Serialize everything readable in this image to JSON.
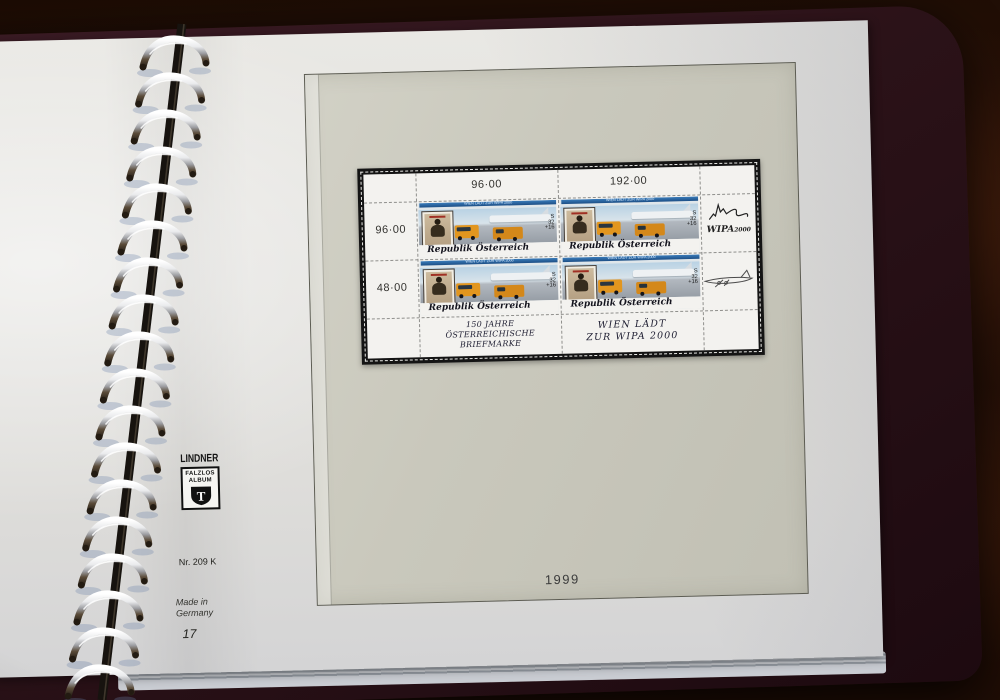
{
  "album": {
    "brand": {
      "name": "LINDNER",
      "box_line1": "FALZLOS",
      "box_line2": "ALBUM",
      "monogram": "T"
    },
    "ref_number": "Nr. 209 K",
    "made_in": {
      "line1": "Made in",
      "line2": "Germany"
    },
    "page_number": "17",
    "year_label": "1999",
    "binder": {
      "ring_count": 18
    }
  },
  "sheet": {
    "top_labels": [
      {
        "text": "96·00"
      },
      {
        "text": "192·00"
      }
    ],
    "left_labels": [
      {
        "text": "96·00"
      },
      {
        "text": "48·00"
      }
    ],
    "caption_left": {
      "line1": "150 JAHRE",
      "line2": "ÖSTERREICHISCHE",
      "line3": "BRIEFMARKE"
    },
    "caption_right": {
      "line1": "WIEN LÄDT",
      "line2": "ZUR WIPA 2000"
    },
    "wipa_logo": {
      "text_main": "WIPA",
      "text_year": "2000"
    },
    "stamp_count": 4,
    "stamp": {
      "top_banner": "WIEN LÄDT ZUR WIPA 2000",
      "country_script": "Republik Österreich",
      "currency": "S",
      "value": "32",
      "surcharge": "+16",
      "inner_stamp_title": "Republik Österreich"
    }
  },
  "colors": {
    "table_wood": "#2a1208",
    "album_cover": "#2b1218",
    "page_paper": "#e2e1dd",
    "foil_panel": "#c9c8bc",
    "mount_black": "#141414",
    "stamp_header_blue": "#2f74b4",
    "stamp_sky": "#b9d2e4",
    "vehicle_orange": "#e2961f",
    "ring_metal": "#d9dadc"
  }
}
